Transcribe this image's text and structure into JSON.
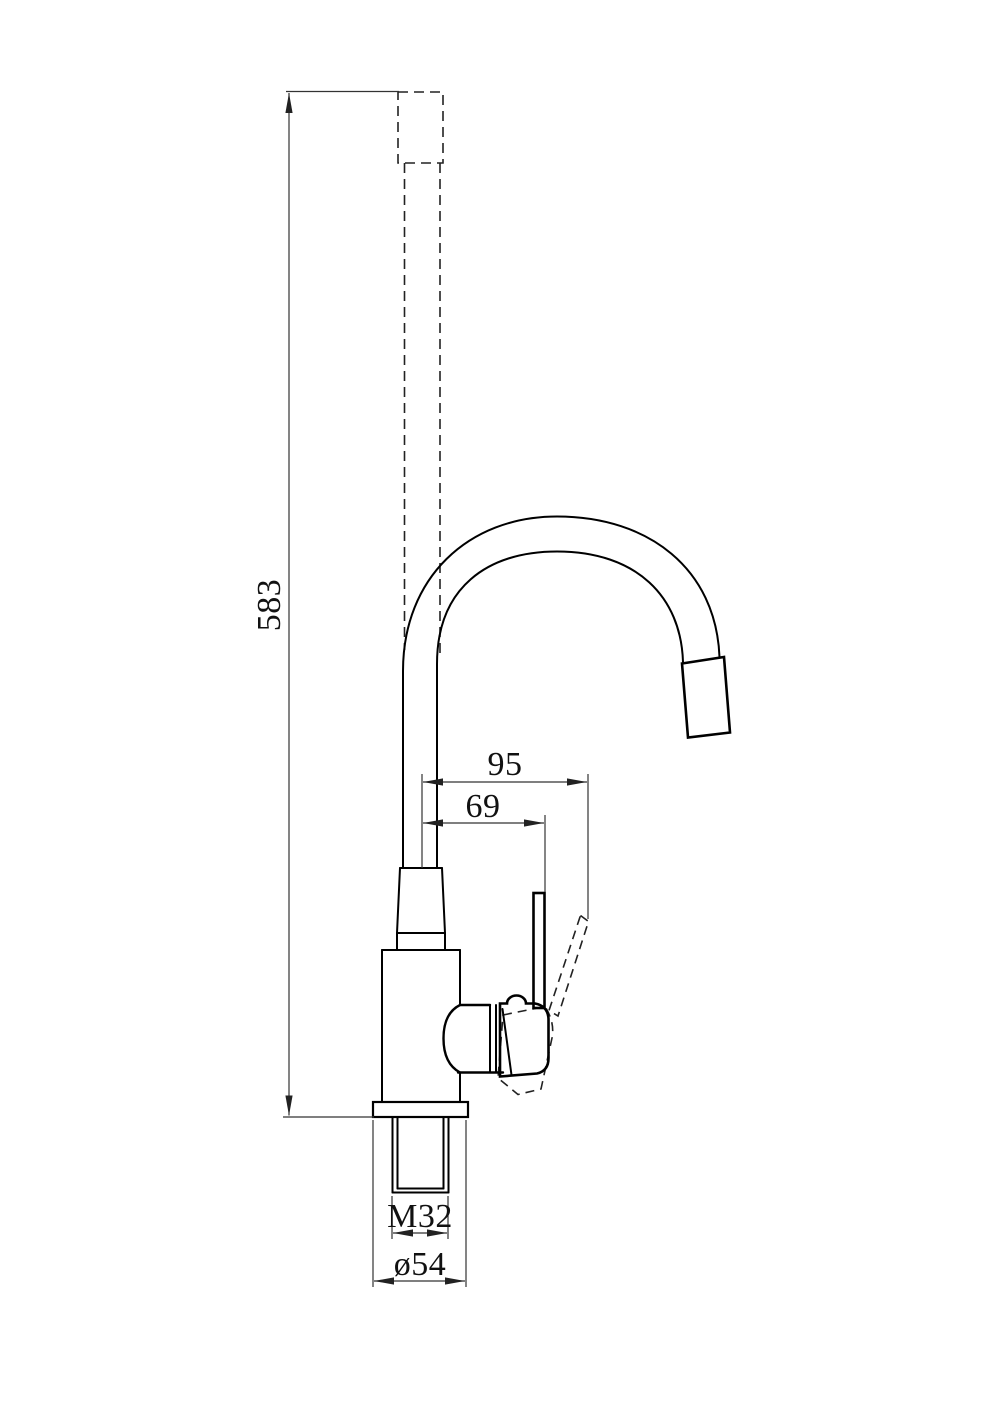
{
  "page": {
    "background_color": "#ffffff",
    "line_color": "#000000",
    "dimension_line_color": "#333333"
  },
  "drawing": {
    "kind": "technical-dimension-drawing",
    "subject": "gooseneck single-handle faucet, side view",
    "dimensions": {
      "overall_height": "583",
      "spout_offset_outer": "95",
      "spout_offset_inner": "69",
      "shank_thread": "M32",
      "base_diameter": "ø54"
    }
  }
}
